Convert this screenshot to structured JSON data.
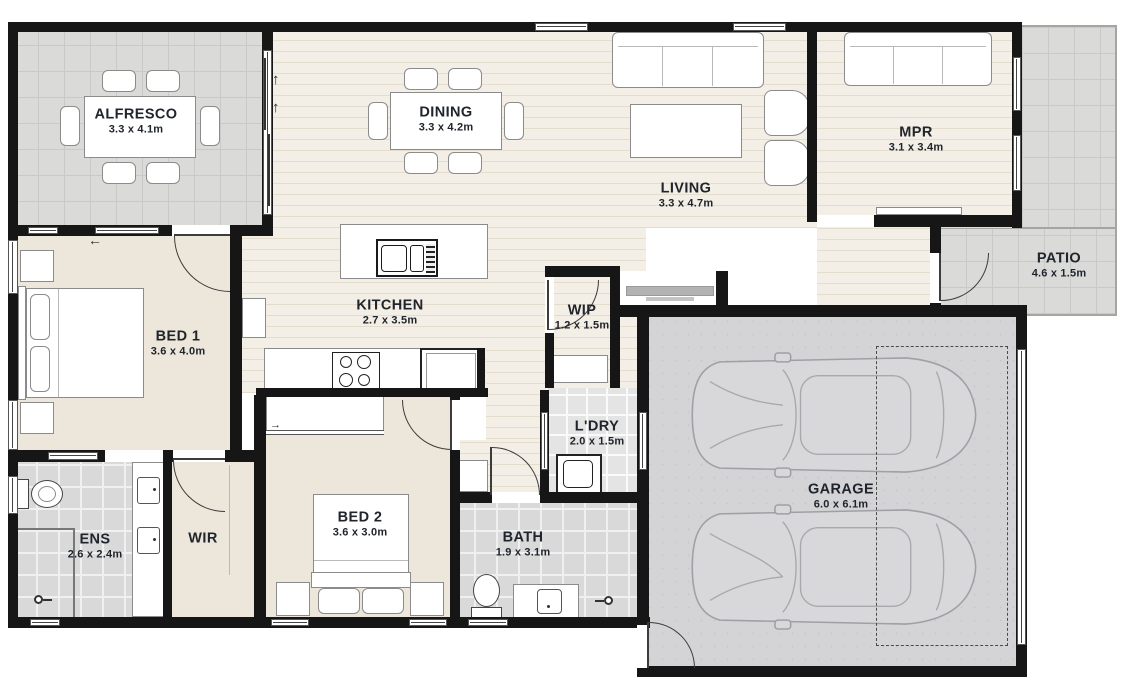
{
  "meta": {
    "type": "residential floor plan"
  },
  "rooms": {
    "alfresco": {
      "label": "ALFRESCO",
      "dims": "3.3 x 4.1m"
    },
    "dining": {
      "label": "DINING",
      "dims": "3.3 x 4.2m"
    },
    "living": {
      "label": "LIVING",
      "dims": "3.3 x 4.7m"
    },
    "mpr": {
      "label": "MPR",
      "dims": "3.1 x 3.4m"
    },
    "patio": {
      "label": "PATIO",
      "dims": "4.6 x 1.5m"
    },
    "bed1": {
      "label": "BED 1",
      "dims": "3.6 x 4.0m"
    },
    "kitchen": {
      "label": "KITCHEN",
      "dims": "2.7 x 3.5m"
    },
    "wip": {
      "label": "WIP",
      "dims": "1.2 x 1.5m"
    },
    "ldry": {
      "label": "L'DRY",
      "dims": "2.0 x 1.5m"
    },
    "garage": {
      "label": "GARAGE",
      "dims": "6.0 x 6.1m"
    },
    "ens": {
      "label": "ENS",
      "dims": "2.6 x 2.4m"
    },
    "wir": {
      "label": "WIR"
    },
    "bed2": {
      "label": "BED 2",
      "dims": "3.6 x 3.0m"
    },
    "bath": {
      "label": "BATH",
      "dims": "1.9 x 3.1m"
    }
  },
  "icons": {
    "slide_up": "↑",
    "slide_left": "←",
    "slide_right": "→"
  },
  "colors": {
    "wall": "#161616",
    "wood_floor": "#f3efe6",
    "carpet": "#ece7da",
    "outdoor_tile": "#dadad8",
    "wet_area_tile": "#d9d9d9",
    "garage_floor": "#d4d4d6",
    "label_text": "#20242c"
  }
}
